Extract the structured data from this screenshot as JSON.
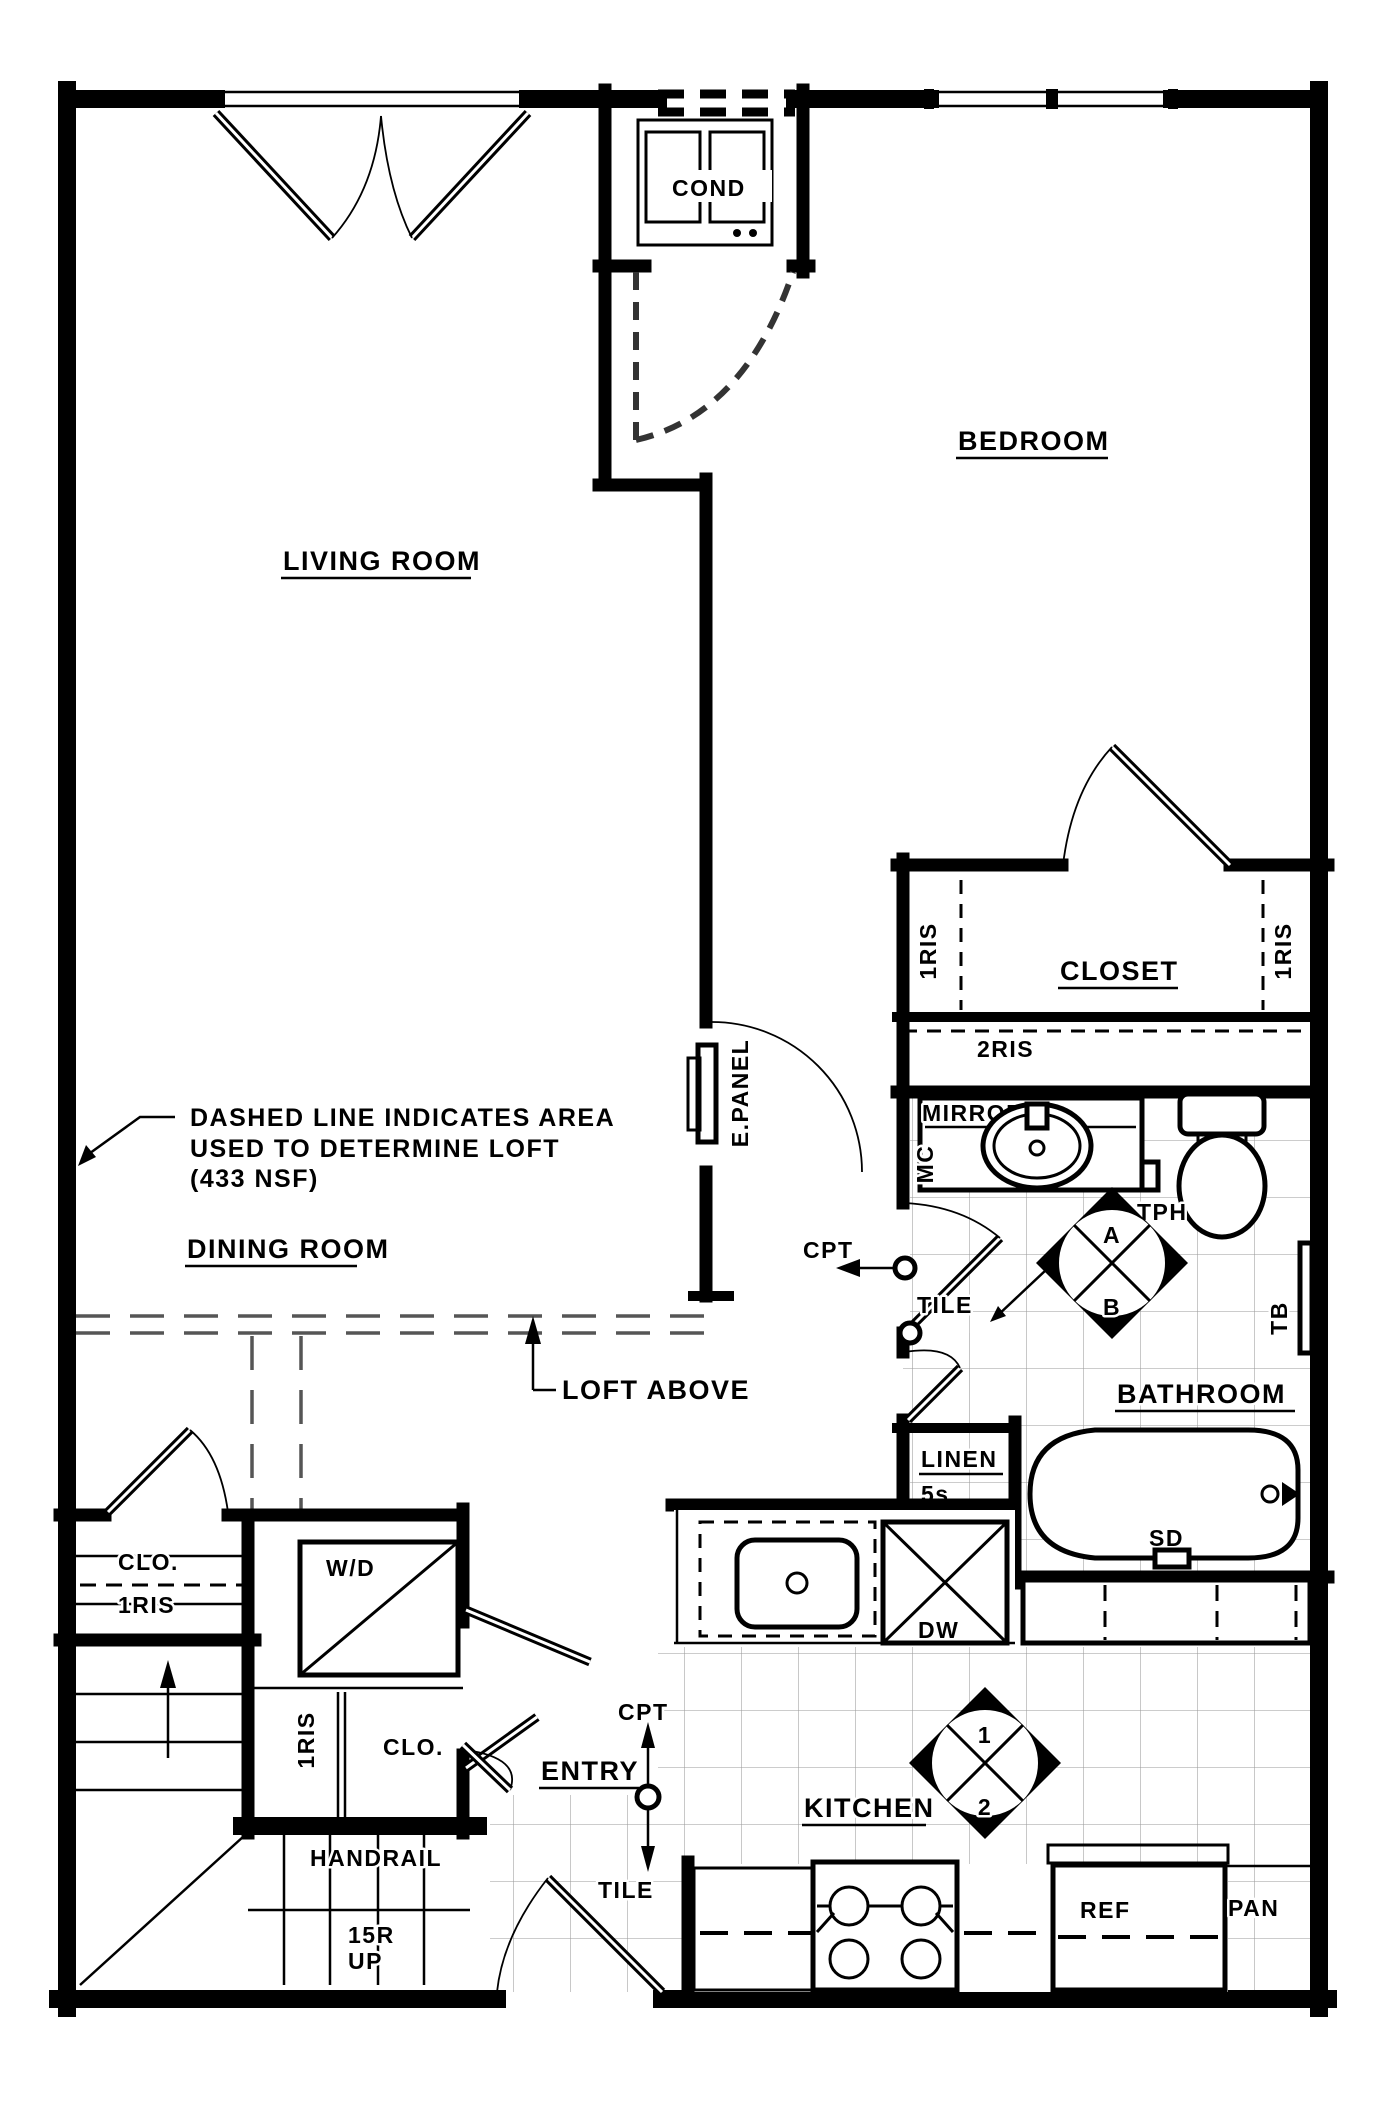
{
  "rooms": {
    "living_room": "LIVING ROOM",
    "dining_room": "DINING ROOM",
    "bedroom": "BEDROOM",
    "closet": "CLOSET",
    "bathroom": "BATHROOM",
    "kitchen": "KITCHEN",
    "entry": "ENTRY"
  },
  "closets": {
    "bedroom_closet": {
      "left_riser": "1RIS",
      "right_riser": "1RIS",
      "base_riser": "2RIS"
    },
    "hall_linen": {
      "label": "LINEN",
      "shelves": "5s"
    },
    "dining_closet": {
      "label": "CLO.",
      "riser": "1RIS"
    },
    "entry_closet": {
      "label": "CLO.",
      "riser": "1RIS"
    }
  },
  "fixtures": {
    "condenser": "COND",
    "electrical_panel": "E.PANEL",
    "washer_dryer": "W/D",
    "dishwasher": "DW",
    "refrigerator": "REF",
    "pantry": "PAN",
    "mirror": "MIRROR",
    "medicine_cabinet": "MC",
    "toilet_paper_holder": "TPH",
    "towel_bar": "TB",
    "shower_door": "SD"
  },
  "finishes": {
    "hall": {
      "carpet": "CPT",
      "tile": "TILE"
    },
    "entry": {
      "carpet": "CPT",
      "tile": "TILE"
    }
  },
  "finish_keys": {
    "bathroom": {
      "upper": "A",
      "lower": "B"
    },
    "kitchen": {
      "upper": "1",
      "lower": "2"
    }
  },
  "stair": {
    "handrail": "HANDRAIL",
    "riser_count": "15R",
    "direction": "UP"
  },
  "notes": {
    "loft_area_line1": "DASHED LINE INDICATES AREA",
    "loft_area_line2": "USED TO DETERMINE LOFT",
    "loft_area_line3": "(433 NSF)",
    "loft_above": "LOFT ABOVE"
  }
}
